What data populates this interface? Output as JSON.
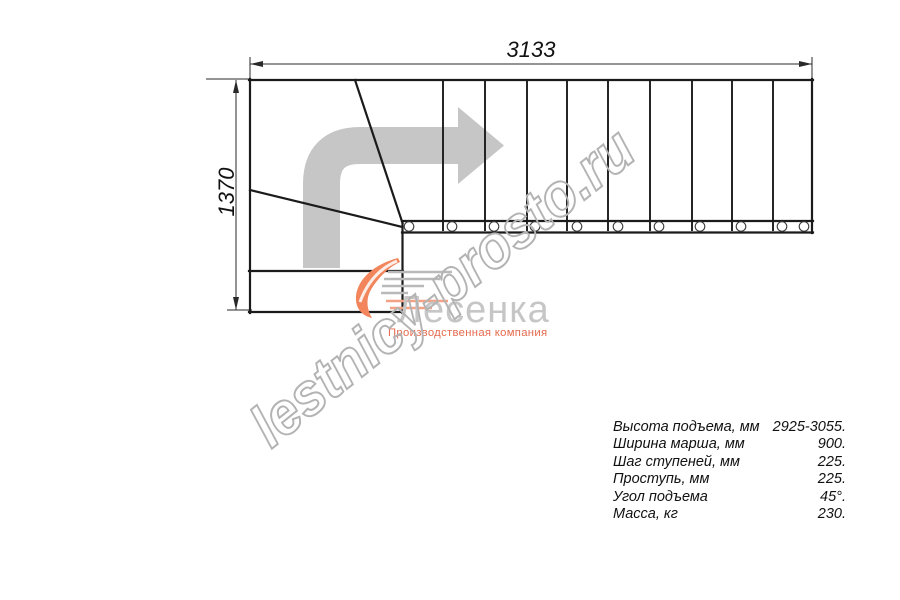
{
  "page": {
    "background": "#ffffff",
    "type_note": "staircase top-view technical drawing"
  },
  "dimensions": {
    "width_label": "3133",
    "height_label": "1370"
  },
  "plan": {
    "step_edge_count": 9,
    "baluster_count": 11,
    "winder_line_count": 2
  },
  "icons": {
    "direction_arrow": "turn-right-arrow"
  },
  "watermark": {
    "text": "lestnicy-prosto.ru",
    "color": "#b3b3b3"
  },
  "logo": {
    "name": "Лесенка",
    "subtitle": "Производственная компания",
    "name_color": "#c6c6c6",
    "accent_color": "#ee7250"
  },
  "specs": {
    "rows": [
      {
        "label": "Высота подъема, мм",
        "value": "2925-3055."
      },
      {
        "label": "Ширина марша, мм",
        "value": "900."
      },
      {
        "label": "Шаг ступеней, мм",
        "value": "225."
      },
      {
        "label": "Проступь, мм",
        "value": "225."
      },
      {
        "label": "Угол подъема",
        "value": "45°."
      },
      {
        "label": "Масса, кг",
        "value": "230."
      }
    ]
  },
  "colors": {
    "drawing_line": "#1b1b1b",
    "dimension_line": "#2a2a2a",
    "arrow_fill": "#c6c6c6"
  }
}
